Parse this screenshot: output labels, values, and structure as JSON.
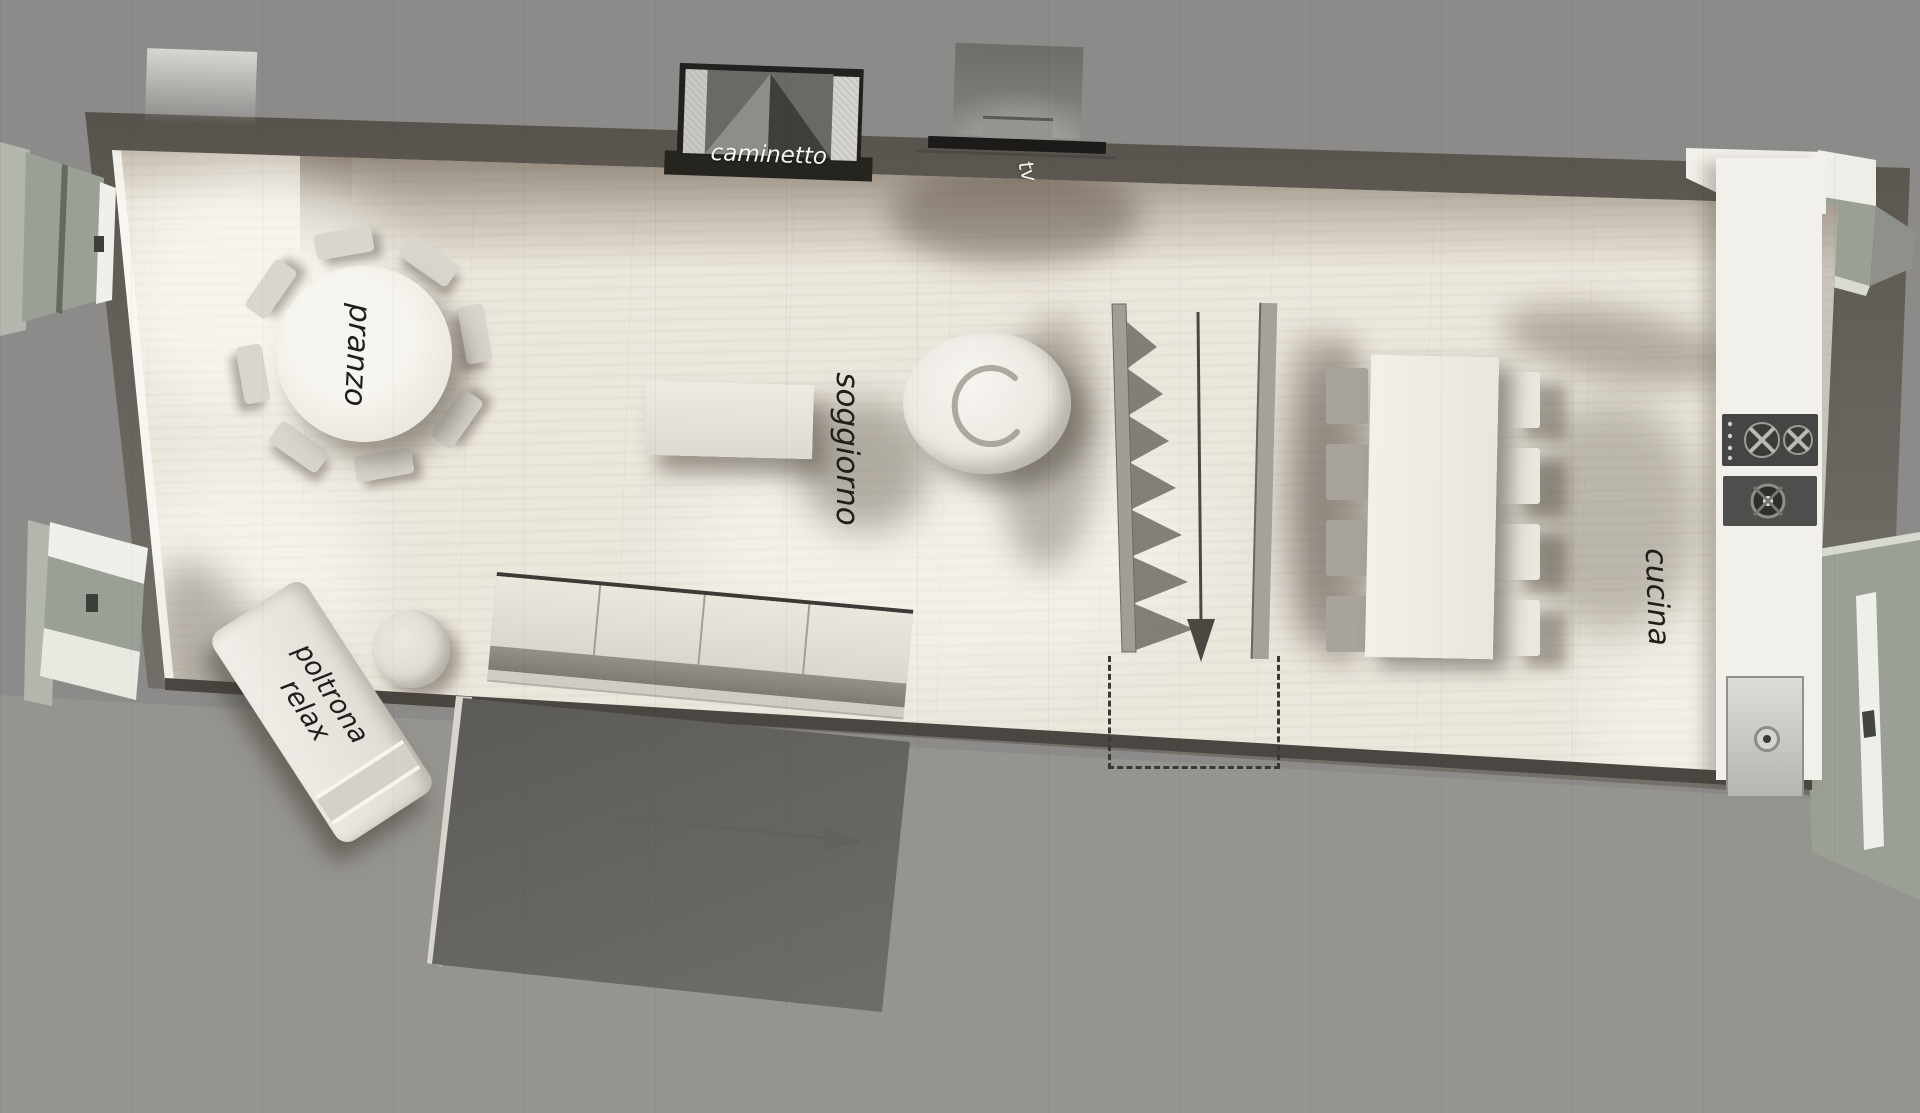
{
  "labels": {
    "fireplace": "caminetto",
    "tv": "tv",
    "dining": "pranzo",
    "living": "soggiorno",
    "armchair_line1": "poltrona",
    "armchair_line2": "relax",
    "kitchen": "cucina"
  },
  "colors": {
    "background": "#8c8b89",
    "walls": "#5f5a53",
    "floor": "#ece7dd",
    "furniture": "#eeebe3",
    "void_area": "#46443f",
    "window_reveal": "#9aa095",
    "label_dark": "#1f1e1b",
    "label_light": "#f4f4f1"
  }
}
